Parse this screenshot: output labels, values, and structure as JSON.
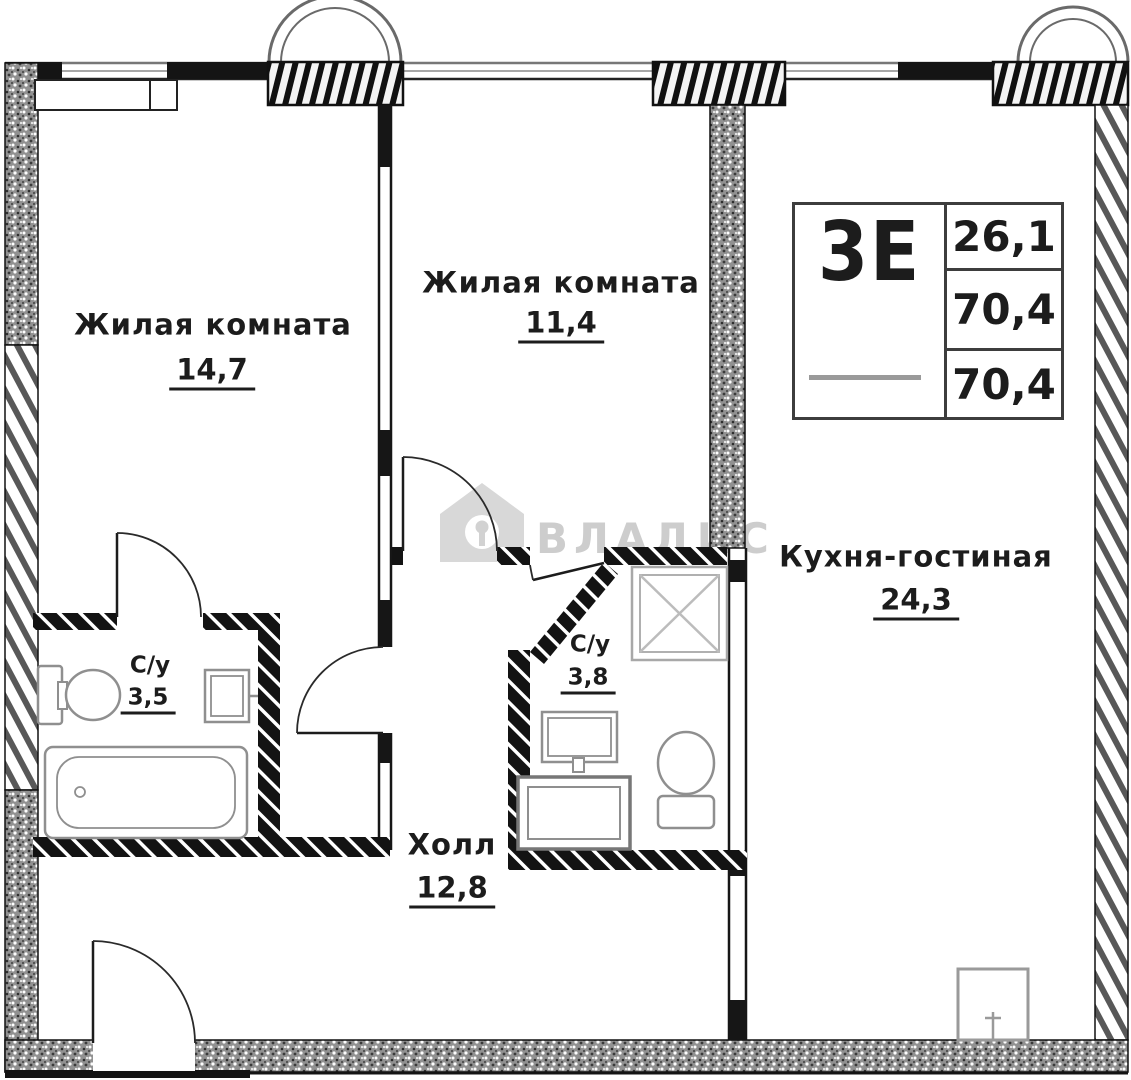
{
  "colors": {
    "ink": "#1c1c1c",
    "wall_hatch_gray": "#585858",
    "fixture_gray": "#8f8f8f",
    "watermark_gray": "#cdcdcd"
  },
  "watermark": {
    "brand": "ВЛАДИС"
  },
  "info_box": {
    "unit_type": "3Е",
    "row1": "26,1",
    "row2": "70,4",
    "row3": "70,4"
  },
  "rooms": {
    "living_room_1": {
      "name": "Жилая комната",
      "area": "14,7"
    },
    "living_room_2": {
      "name": "Жилая комната",
      "area": "11,4"
    },
    "kitchen_living": {
      "name": "Кухня-гостиная",
      "area": "24,3"
    },
    "hall": {
      "name": "Холл",
      "area": "12,8"
    },
    "bathroom_1": {
      "name": "С/у",
      "area": "3,5"
    },
    "bathroom_2": {
      "name": "С/у",
      "area": "3,8"
    }
  }
}
